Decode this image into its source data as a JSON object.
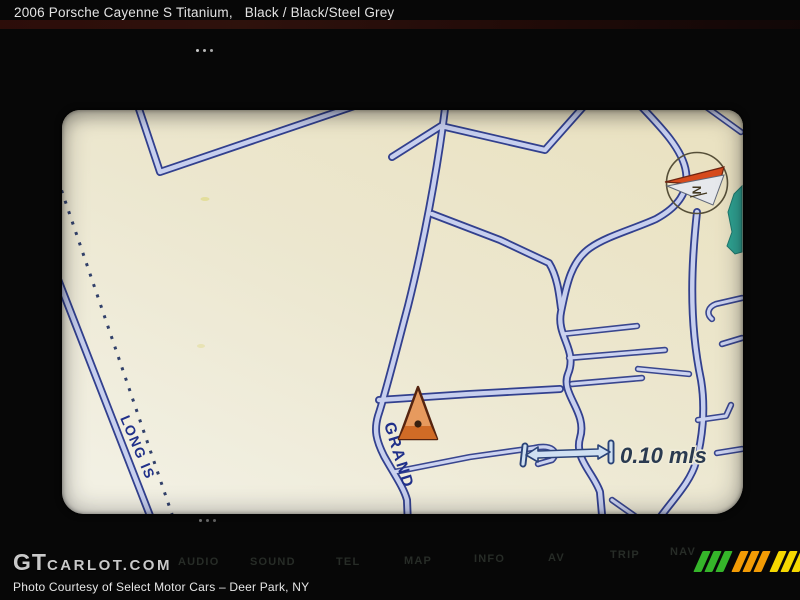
{
  "page": {
    "title_car": "2006 Porsche Cayenne S Titanium,",
    "title_color": "Black / Black/Steel Grey"
  },
  "nav_screen": {
    "street_labels": [
      {
        "name": "LONG IS"
      },
      {
        "name": "GRAND"
      }
    ],
    "scale": {
      "text": "0.10 mls"
    },
    "compass": {
      "label": "N"
    }
  },
  "dashboard": {
    "buttons": [
      {
        "label": "AUDIO"
      },
      {
        "label": "SOUND"
      },
      {
        "label": "TEL"
      },
      {
        "label": "MAP"
      },
      {
        "label": "INFO"
      },
      {
        "label": "AV"
      },
      {
        "label": "TRIP"
      },
      {
        "label": "NAV"
      }
    ]
  },
  "footer": {
    "logo_gt": "GT",
    "logo_rest": "CARLOT.COM",
    "caption": "Photo Courtesy of Select Motor Cars – Deer Park, NY"
  },
  "icons": {
    "compass": "compass-needle",
    "car_marker": "position-triangle",
    "scale_bar": "double-headed-arrow",
    "brand_stripes": "three-color-diagonal-stripes"
  },
  "colors": {
    "map_background": "#ece7cf",
    "road_fill": "#c7cfee",
    "road_casing": "#32408e",
    "water": "#2fa493",
    "marker_orange": "#e79a5e",
    "needle_red": "#d64a1c",
    "label_navy": "#20308a",
    "logo_green": "#35b52a",
    "logo_orange": "#f29b05",
    "logo_yellow": "#f5d800"
  }
}
